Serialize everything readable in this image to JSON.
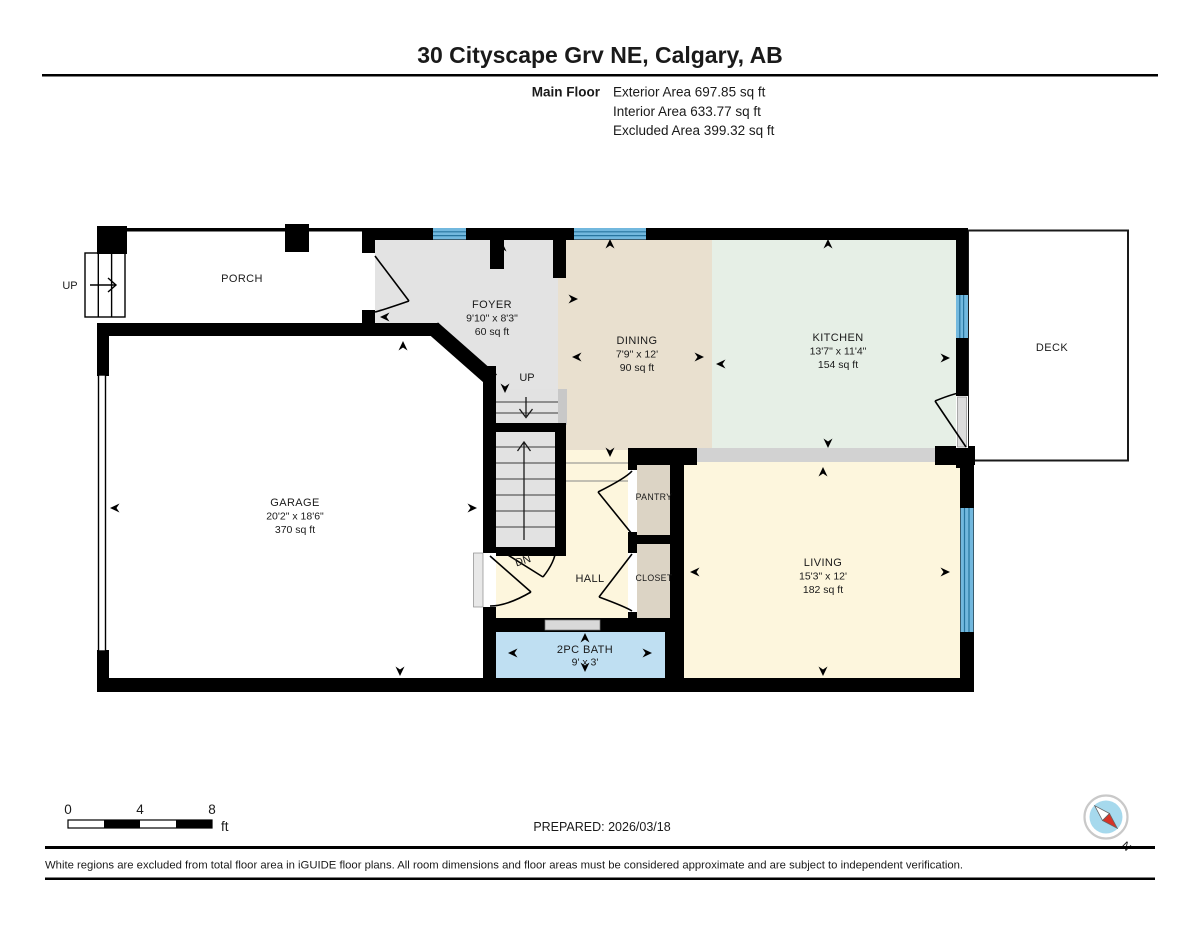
{
  "header": {
    "title": "30 Cityscape Grv NE, Calgary, AB",
    "floor_label": "Main Floor",
    "area_lines": [
      "Exterior Area 697.85 sq ft",
      "Interior Area 633.77 sq ft",
      "Excluded Area 399.32 sq ft"
    ]
  },
  "rooms": {
    "porch": {
      "name": "PORCH"
    },
    "foyer": {
      "name": "FOYER",
      "dims": "9'10\" x 8'3\"",
      "area": "60 sq ft"
    },
    "dining": {
      "name": "DINING",
      "dims": "7'9\" x 12'",
      "area": "90 sq ft"
    },
    "kitchen": {
      "name": "KITCHEN",
      "dims": "13'7\" x 11'4\"",
      "area": "154 sq ft"
    },
    "deck": {
      "name": "DECK"
    },
    "garage": {
      "name": "GARAGE",
      "dims": "20'2\" x 18'6\"",
      "area": "370 sq ft"
    },
    "living": {
      "name": "LIVING",
      "dims": "15'3\" x 12'",
      "area": "182 sq ft"
    },
    "hall": {
      "name": "HALL"
    },
    "pantry": {
      "name": "PANTRY"
    },
    "closet": {
      "name": "CLOSET"
    },
    "bath": {
      "name": "2PC BATH",
      "dims": "9' x 3'"
    }
  },
  "stairs": {
    "up_label": "UP",
    "dn_label": "DN",
    "porch_up_label": "UP"
  },
  "scale_bar": {
    "tick_0": "0",
    "tick_4": "4",
    "tick_8": "8",
    "unit": "ft"
  },
  "footer": {
    "prepared": "PREPARED: 2026/03/18",
    "disclaimer": "White regions are excluded from total floor area in iGUIDE floor plans. All room dimensions and floor areas must be considered approximate and are subject to independent verification."
  },
  "compass": {
    "north_label": "N"
  },
  "colors": {
    "wall": "#000000",
    "foyer": "#e3e3e3",
    "dining": "#e9e0cf",
    "kitchen": "#e6efe6",
    "living": "#fdf6dd",
    "hall": "#fdf6dd",
    "bath": "#bfdff2",
    "pantry": "#dcd4c5",
    "closet": "#dcd4c5",
    "stairs": "#e2e2e2",
    "divider_band": "#d2d2d2",
    "window": "#72b8de",
    "window_line": "#27759f",
    "compass_blue": "#a6d9ed",
    "compass_red": "#d63327"
  }
}
